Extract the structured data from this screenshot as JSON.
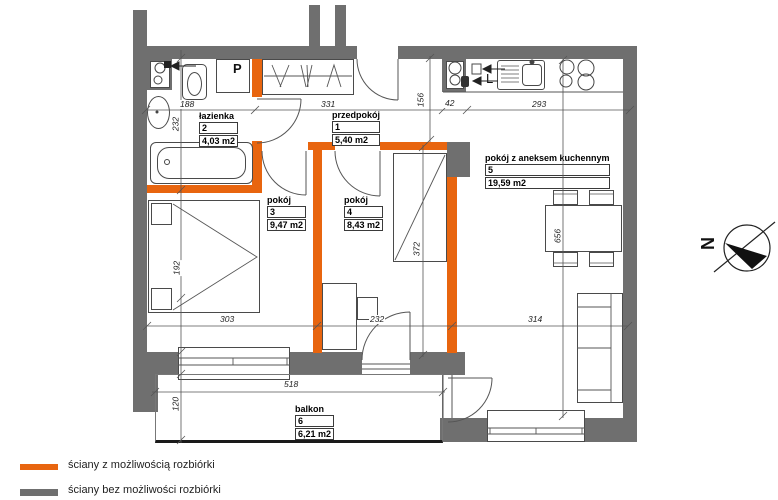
{
  "plan": {
    "rooms": [
      {
        "name": "przedpokój",
        "number": "1",
        "area": "5,40 m2"
      },
      {
        "name": "łazienka",
        "number": "2",
        "area": "4,03 m2"
      },
      {
        "name": "pokój",
        "number": "3",
        "area": "9,47 m2"
      },
      {
        "name": "pokój",
        "number": "4",
        "area": "8,43 m2"
      },
      {
        "name": "pokój z aneksem kuchennym",
        "number": "5",
        "area": "19,59 m2"
      },
      {
        "name": "balkon",
        "number": "6",
        "area": "6,21 m2"
      }
    ],
    "markers": {
      "washing_machine": "P",
      "fridge": "L"
    },
    "compass": {
      "north_label": "N"
    },
    "dimensions_cm": {
      "top": [
        "188",
        "331",
        "42",
        "293"
      ],
      "middle": [
        "303",
        "232",
        "314"
      ],
      "bottom": [
        "518"
      ],
      "left_vertical": [
        "232",
        "192",
        "120"
      ],
      "hall_height": "156",
      "room4_height": "372",
      "room5_height": "656"
    }
  },
  "legend": {
    "items": [
      {
        "label": "ściany z możliwością rozbiórki",
        "color": "#e8650f"
      },
      {
        "label": "ściany bez możliwości rozbiórki",
        "color": "#6f6f6f"
      }
    ]
  },
  "colors": {
    "demolishable_wall": "#e8650f",
    "load_bearing_wall": "#6f6f6f"
  }
}
